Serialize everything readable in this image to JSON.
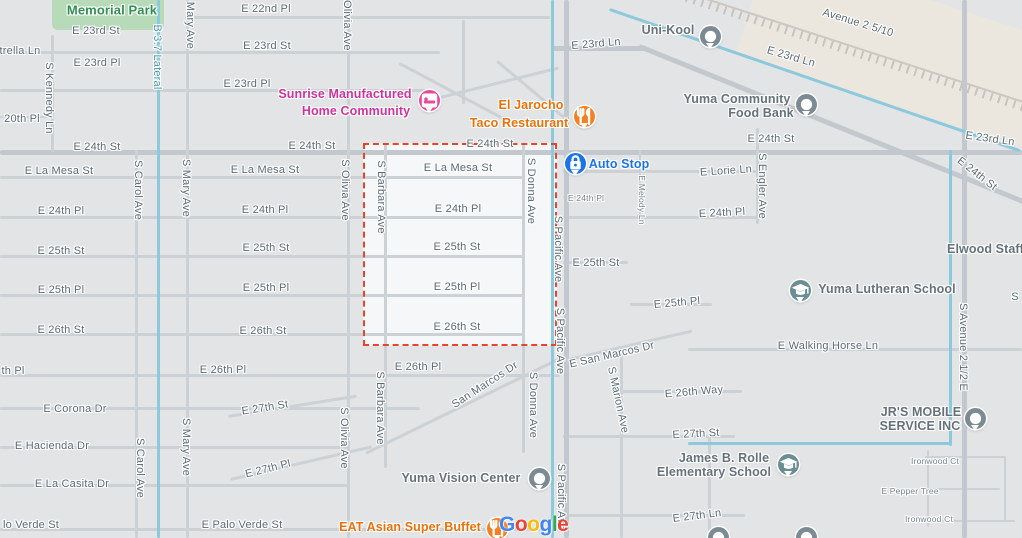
{
  "map": {
    "provider_watermark": {
      "x": 499,
      "y": 513,
      "letters": [
        {
          "ch": "G",
          "color": "#4285F4"
        },
        {
          "ch": "o",
          "color": "#EA4335"
        },
        {
          "ch": "o",
          "color": "#FBBC05"
        },
        {
          "ch": "g",
          "color": "#4285F4"
        },
        {
          "ch": "l",
          "color": "#34A853"
        },
        {
          "ch": "e",
          "color": "#EA4335"
        }
      ]
    },
    "highlight_region": {
      "x": 363,
      "y": 143,
      "w": 194,
      "h": 203,
      "border_color": "#e8432c",
      "fill": "#f6f7f8"
    },
    "colors": {
      "background": "#e2e4e6",
      "road": "#ccd1d6",
      "road_major": "#c2c8ce",
      "canal": "#8cc9dc",
      "park": "#b7dbb9",
      "street_text": "#5b6a76",
      "poi_pink": "#cf319e",
      "poi_orange": "#e8710a",
      "poi_blue": "#1a73e8",
      "poi_slate": "#65717b",
      "poi_green": "#2f8f4f",
      "selection_red": "#e8432c"
    },
    "street_labels": [
      {
        "t": "E 22nd Pl",
        "x": 266,
        "y": 9
      },
      {
        "t": "E 23rd St",
        "x": 96,
        "y": 31
      },
      {
        "t": "E 23rd St",
        "x": 267,
        "y": 46
      },
      {
        "t": "E 23rd Ln",
        "x": 596,
        "y": 44,
        "r": -5
      },
      {
        "t": "E 23rd Ln",
        "x": 791,
        "y": 57,
        "r": 16
      },
      {
        "t": "Avenue 2 5/10",
        "x": 858,
        "y": 23,
        "r": 17
      },
      {
        "t": "E 23rd Pl",
        "x": 97,
        "y": 63
      },
      {
        "t": "E 23rd Pl",
        "x": 247,
        "y": 84
      },
      {
        "t": "trella Ln",
        "x": 20,
        "y": 51
      },
      {
        "t": "20th Pl",
        "x": 22,
        "y": 119
      },
      {
        "t": "E 24th St",
        "x": 97,
        "y": 147
      },
      {
        "t": "E 24th St",
        "x": 312,
        "y": 146
      },
      {
        "t": "E 24th St",
        "x": 490,
        "y": 144
      },
      {
        "t": "E 24th St",
        "x": 771,
        "y": 139
      },
      {
        "t": "E 23rd Ln",
        "x": 990,
        "y": 139,
        "r": 8
      },
      {
        "t": "E 24th St",
        "x": 977,
        "y": 174,
        "r": 38
      },
      {
        "t": "E La Mesa St",
        "x": 59,
        "y": 171
      },
      {
        "t": "E La Mesa St",
        "x": 265,
        "y": 170
      },
      {
        "t": "E La Mesa St",
        "x": 458,
        "y": 168
      },
      {
        "t": "E 24th Pl",
        "x": 61,
        "y": 211
      },
      {
        "t": "E 24th Pl",
        "x": 265,
        "y": 210
      },
      {
        "t": "E 24th Pl",
        "x": 458,
        "y": 209
      },
      {
        "t": "E 24th Pl",
        "x": 586,
        "y": 198,
        "s": "sm"
      },
      {
        "t": "E 24th Pl",
        "x": 722,
        "y": 213,
        "r": -3
      },
      {
        "t": "E Lorie Ln",
        "x": 726,
        "y": 171,
        "r": -4
      },
      {
        "t": "E 25th St",
        "x": 61,
        "y": 251
      },
      {
        "t": "E 25th St",
        "x": 266,
        "y": 248
      },
      {
        "t": "E 25th St",
        "x": 457,
        "y": 247
      },
      {
        "t": "E 25th St",
        "x": 596,
        "y": 263
      },
      {
        "t": "E 25th Pl",
        "x": 61,
        "y": 290
      },
      {
        "t": "E 25th Pl",
        "x": 266,
        "y": 288
      },
      {
        "t": "E 25th Pl",
        "x": 457,
        "y": 287
      },
      {
        "t": "E 25th Pl",
        "x": 677,
        "y": 303,
        "r": -5
      },
      {
        "t": "E 26th St",
        "x": 61,
        "y": 330
      },
      {
        "t": "E 26th St",
        "x": 263,
        "y": 331
      },
      {
        "t": "E 26th St",
        "x": 457,
        "y": 327
      },
      {
        "t": "E 26th Pl",
        "x": 223,
        "y": 370
      },
      {
        "t": "E 26th Pl",
        "x": 418,
        "y": 367
      },
      {
        "t": "th Pl",
        "x": 13,
        "y": 371
      },
      {
        "t": "E Walking Horse Ln",
        "x": 828,
        "y": 346
      },
      {
        "t": "E San Marcos Dr",
        "x": 612,
        "y": 355,
        "r": -13
      },
      {
        "t": "San Marcos Dr",
        "x": 485,
        "y": 385,
        "r": -33
      },
      {
        "t": "E 26th Way",
        "x": 694,
        "y": 392,
        "r": -5
      },
      {
        "t": "E Corona Dr",
        "x": 75,
        "y": 409
      },
      {
        "t": "E Hacienda Dr",
        "x": 52,
        "y": 446
      },
      {
        "t": "E La Casita Dr",
        "x": 72,
        "y": 484
      },
      {
        "t": "E 27th St",
        "x": 265,
        "y": 408,
        "r": -9
      },
      {
        "t": "E 27th St",
        "x": 696,
        "y": 434,
        "r": -3
      },
      {
        "t": "E 27th Pl",
        "x": 268,
        "y": 469,
        "r": -14
      },
      {
        "t": "E 27th Ln",
        "x": 697,
        "y": 516,
        "r": -7
      },
      {
        "t": "lo Verde St",
        "x": 31,
        "y": 525
      },
      {
        "t": "E Palo Verde St",
        "x": 242,
        "y": 525
      },
      {
        "t": "Ironwood Ct",
        "x": 935,
        "y": 461,
        "s": "sm"
      },
      {
        "t": "E Pepper Tree",
        "x": 910,
        "y": 491,
        "s": "sm"
      },
      {
        "t": "Ironwood Ct",
        "x": 929,
        "y": 519,
        "s": "sm"
      },
      {
        "t": "S",
        "x": 1015,
        "y": 297
      },
      {
        "t": "S Kennedy Ln",
        "x": 49,
        "y": 98,
        "r": 90
      },
      {
        "t": "S Carol Ave",
        "x": 138,
        "y": 190,
        "r": 90
      },
      {
        "t": "S Carol Ave",
        "x": 140,
        "y": 468,
        "r": 90
      },
      {
        "t": "S Mary Ave",
        "x": 190,
        "y": 20,
        "r": 90
      },
      {
        "t": "S Mary Ave",
        "x": 186,
        "y": 188,
        "r": 90
      },
      {
        "t": "S Mary Ave",
        "x": 186,
        "y": 447,
        "r": 90
      },
      {
        "t": "S Olivia Ave",
        "x": 347,
        "y": 20,
        "r": 90
      },
      {
        "t": "S Olivia Ave",
        "x": 345,
        "y": 190,
        "r": 90
      },
      {
        "t": "S Olivia Ave",
        "x": 344,
        "y": 438,
        "r": 90
      },
      {
        "t": "S Barbara Ave",
        "x": 381,
        "y": 197,
        "r": 90
      },
      {
        "t": "S Barbara Ave",
        "x": 380,
        "y": 408,
        "r": 90
      },
      {
        "t": "S Donna Ave",
        "x": 531,
        "y": 191,
        "r": 90
      },
      {
        "t": "S Donna Ave",
        "x": 533,
        "y": 405,
        "r": 90
      },
      {
        "t": "S Pacific Ave",
        "x": 558,
        "y": 249,
        "r": 90
      },
      {
        "t": "S Pacific Ave",
        "x": 560,
        "y": 341,
        "r": 90
      },
      {
        "t": "S Pacific Ave",
        "x": 561,
        "y": 497,
        "r": 90
      },
      {
        "t": "S Engler Ave",
        "x": 762,
        "y": 186,
        "r": 90
      },
      {
        "t": "E Melody Ln",
        "x": 642,
        "y": 200,
        "r": 90,
        "s": "sm"
      },
      {
        "t": "S Marion Ave",
        "x": 618,
        "y": 400,
        "r": 78
      },
      {
        "t": "S Avenue 2 1/2 E",
        "x": 963,
        "y": 347,
        "r": 90
      },
      {
        "t": "B 3.7 Lateral",
        "x": 157,
        "y": 57,
        "r": 90,
        "c": "canal-name"
      }
    ],
    "pois": [
      {
        "id": "memorial-park",
        "color_class": "poi-green",
        "lines": [
          {
            "t": "Memorial Park",
            "x": 112,
            "y": 10
          }
        ]
      },
      {
        "id": "sunrise-manufactured-home-community",
        "color_class": "poi-pink",
        "lines": [
          {
            "t": "Sunrise Manufactured",
            "x": 345,
            "y": 94
          },
          {
            "t": "Home Community",
            "x": 356,
            "y": 111
          }
        ],
        "pin": {
          "x": 429,
          "y": 100,
          "type": "lodging",
          "color": "#e8499b"
        }
      },
      {
        "id": "el-jarocho-taco-restaurant",
        "color_class": "poi-orange",
        "lines": [
          {
            "t": "El Jarocho",
            "x": 531,
            "y": 105
          },
          {
            "t": "Taco Restaurant",
            "x": 519,
            "y": 123
          }
        ],
        "pin": {
          "x": 584,
          "y": 116,
          "type": "restaurant",
          "color": "#f48024"
        }
      },
      {
        "id": "uni-kool",
        "color_class": "poi-slate",
        "lines": [
          {
            "t": "Uni-Kool",
            "x": 668,
            "y": 30
          }
        ],
        "pin": {
          "x": 710,
          "y": 36,
          "type": "generic",
          "color": "#7b8a93"
        }
      },
      {
        "id": "yuma-community-food-bank",
        "color_class": "poi-slate",
        "lines": [
          {
            "t": "Yuma Community",
            "x": 737,
            "y": 99
          },
          {
            "t": "Food Bank",
            "x": 761,
            "y": 113
          }
        ],
        "pin": {
          "x": 806,
          "y": 104,
          "type": "generic",
          "color": "#7b8a93"
        }
      },
      {
        "id": "auto-stop",
        "color_class": "poi-blue",
        "lines": [
          {
            "t": "Auto Stop",
            "x": 619,
            "y": 164
          }
        ],
        "pin": {
          "x": 575,
          "y": 163,
          "type": "lock",
          "color": "#1a73e8"
        }
      },
      {
        "id": "elwood-staffing",
        "color_class": "poi-slate",
        "lines": [
          {
            "t": "Elwood Staffing",
            "x": 995,
            "y": 249
          }
        ]
      },
      {
        "id": "yuma-lutheran-school",
        "color_class": "poi-slate",
        "lines": [
          {
            "t": "Yuma Lutheran School",
            "x": 887,
            "y": 289
          }
        ],
        "pin": {
          "x": 800,
          "y": 290,
          "type": "school",
          "color": "#6b8d94"
        }
      },
      {
        "id": "jrs-mobile-service-inc",
        "color_class": "poi-slate",
        "lines": [
          {
            "t": "JR'S MOBILE",
            "x": 921,
            "y": 412
          },
          {
            "t": "SERVICE INC",
            "x": 920,
            "y": 426
          }
        ],
        "pin": {
          "x": 975,
          "y": 418,
          "type": "generic",
          "color": "#7b8a93"
        }
      },
      {
        "id": "james-b-rolle-elementary-school",
        "color_class": "poi-slate",
        "lines": [
          {
            "t": "James B. Rolle",
            "x": 724,
            "y": 458
          },
          {
            "t": "Elementary School",
            "x": 714,
            "y": 472
          }
        ],
        "pin": {
          "x": 788,
          "y": 464,
          "type": "school",
          "color": "#6b8d94"
        }
      },
      {
        "id": "yuma-vision-center",
        "color_class": "poi-slate",
        "lines": [
          {
            "t": "Yuma Vision Center",
            "x": 461,
            "y": 478
          }
        ],
        "pin": {
          "x": 539,
          "y": 478,
          "type": "generic",
          "color": "#7b8a93"
        }
      },
      {
        "id": "eat-asian-super-buffet",
        "color_class": "poi-orange",
        "lines": [
          {
            "t": "EAT Asian Super Buffet",
            "x": 410,
            "y": 527
          }
        ],
        "pin": {
          "x": 497,
          "y": 528,
          "type": "restaurant",
          "color": "#f48024"
        }
      },
      {
        "id": "unnamed-place-1",
        "color_class": "poi-slate",
        "lines": [],
        "pin": {
          "x": 718,
          "y": 537,
          "type": "generic",
          "color": "#7b8a93"
        }
      },
      {
        "id": "unnamed-place-2",
        "color_class": "poi-slate",
        "lines": [],
        "pin": {
          "x": 806,
          "y": 537,
          "type": "generic",
          "color": "#7b8a93"
        }
      }
    ]
  }
}
